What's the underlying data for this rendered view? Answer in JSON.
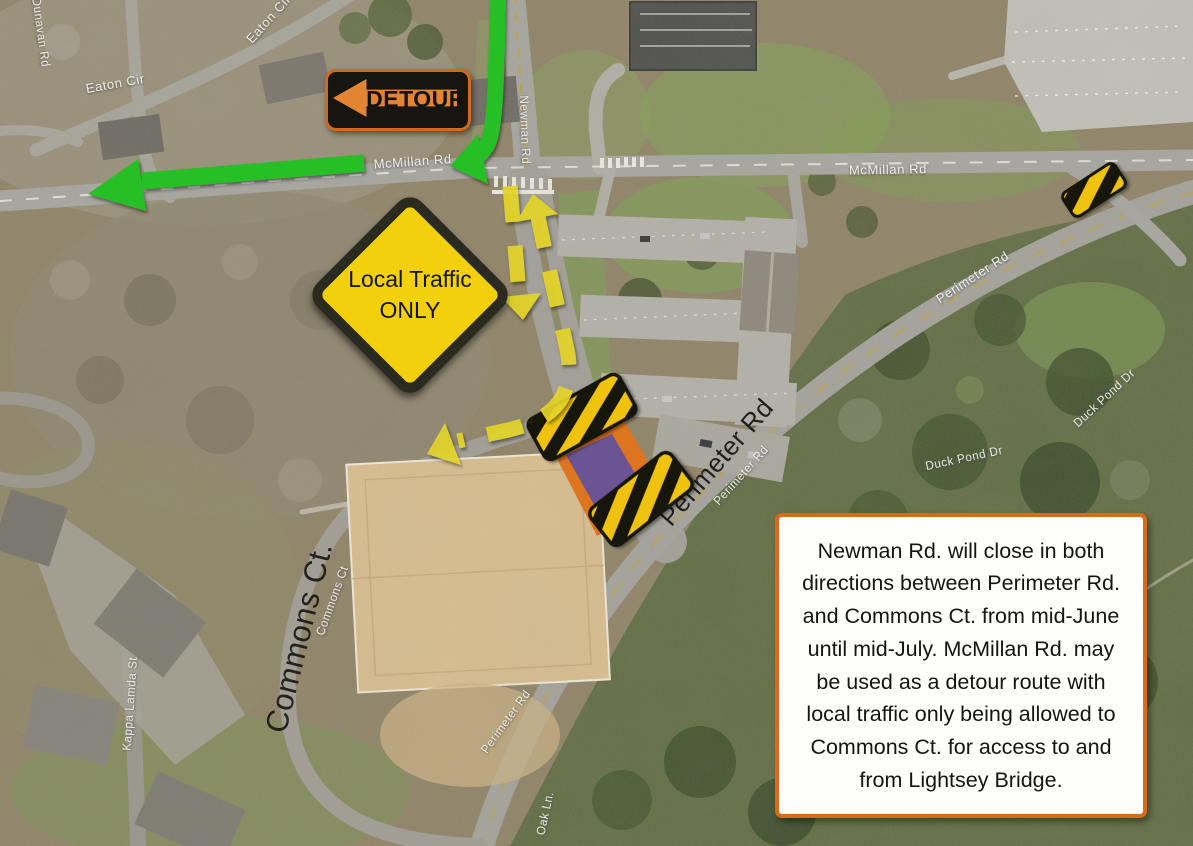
{
  "map": {
    "road_labels": {
      "mcmillan_w": "McMillan Rd",
      "mcmillan_e": "McMillan Rd",
      "newman": "Newman Rd",
      "dunavan": "Dunavan Rd",
      "eaton_1": "Eaton Cir",
      "eaton_2": "Eaton Cir",
      "perimeter_ne": "Perimeter Rd",
      "perimeter_mid": "Perimeter Rd",
      "perimeter_s": "Perimeter Rd",
      "duck_pond_1": "Duck Pond Dr",
      "duck_pond_2": "Duck Pond Dr",
      "kappa_lamda": "Kappa Lamda St",
      "oak_ln": "Oak Ln.",
      "commons_small": "Commons Ct"
    },
    "annotation_labels": {
      "commons_ct": "Commons Ct.",
      "perimeter_rd": "Perimeter Rd"
    }
  },
  "signs": {
    "detour": {
      "label": "DETOUR"
    },
    "local_traffic": {
      "line1": "Local Traffic",
      "line2": "ONLY"
    }
  },
  "info_box": {
    "text": "Newman Rd. will close in both directions between Perimeter Rd. and Commons Ct. from mid-June until mid-July. McMillan Rd. may be used as a detour route with local traffic only being allowed to Commons Ct. for access to and from Lightsey Bridge."
  },
  "colors": {
    "detour_green": "#25bf25",
    "route_dash_yellow": "#e3d42c",
    "sign_yellow": "#f2d10c",
    "sign_border_orange": "#d96a18",
    "detour_sign_orange": "#e38432",
    "barrier_yellow": "#efc308",
    "barrier_black": "#191508",
    "closure_purple": "#6b5494",
    "closure_curb_orange": "#dd7420"
  }
}
